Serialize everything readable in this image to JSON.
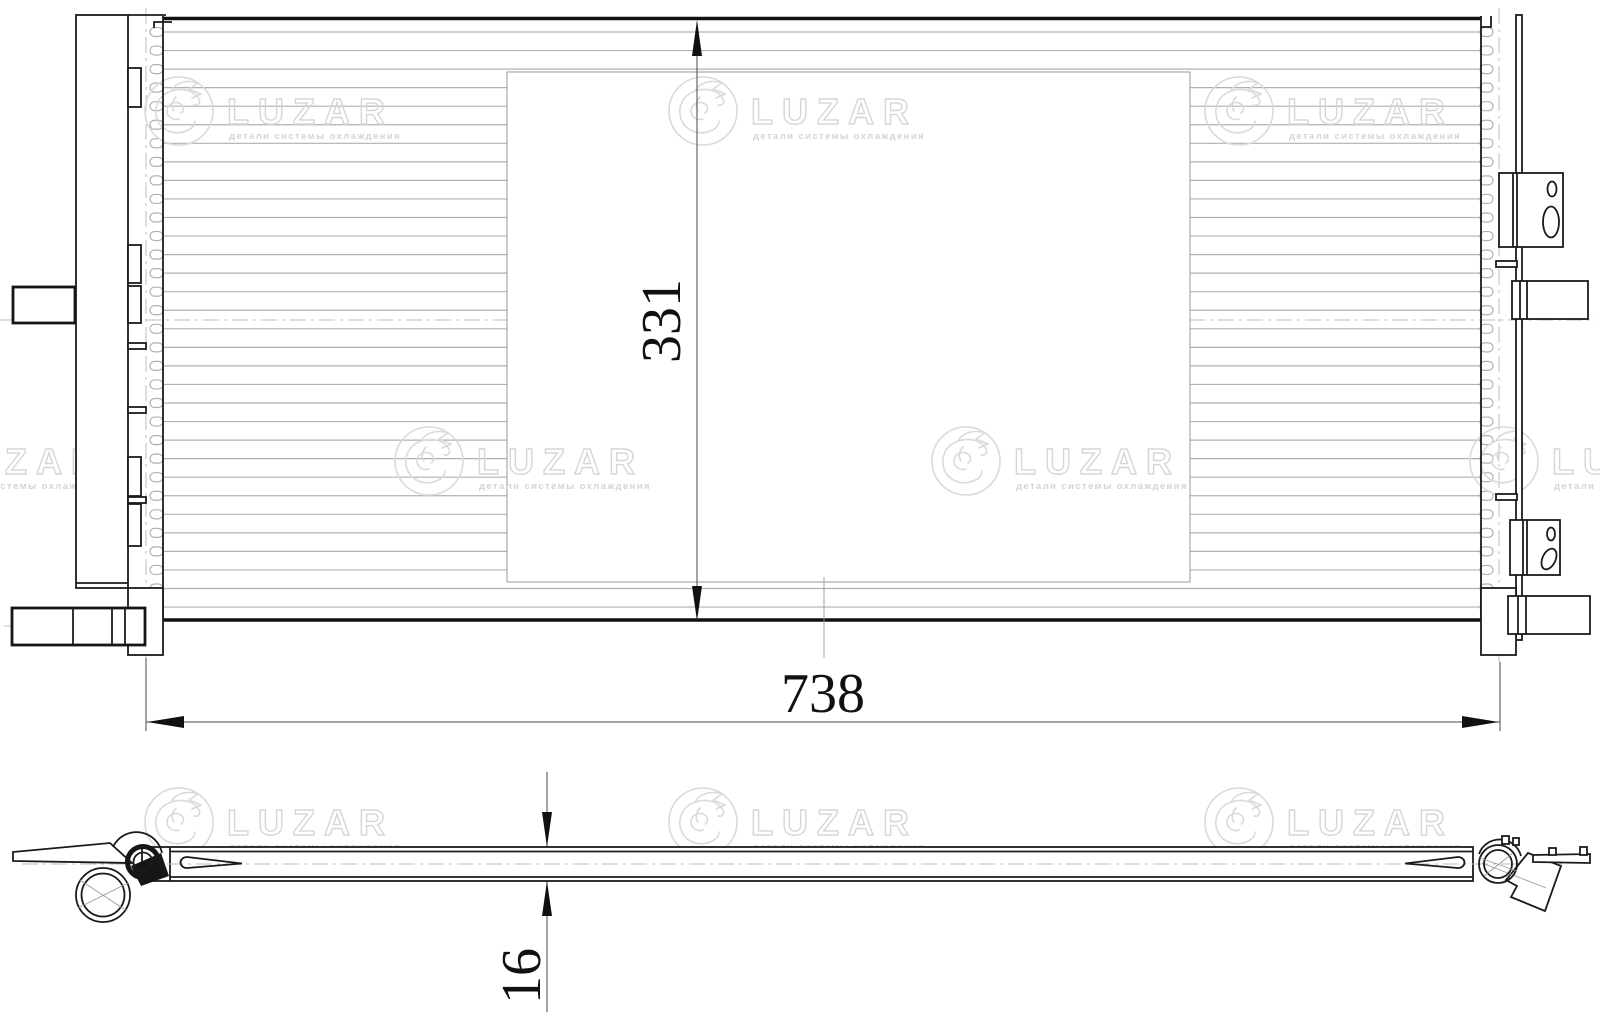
{
  "drawing": {
    "brand": "LUZAR",
    "brand_tagline": "детали системы охлаждения",
    "dims": {
      "width": "738",
      "height": "331",
      "thickness": "16"
    }
  },
  "colors": {
    "ink": "#1b1b1b",
    "fin": "#b0b0b0",
    "watermark": "#d9d9d9"
  }
}
